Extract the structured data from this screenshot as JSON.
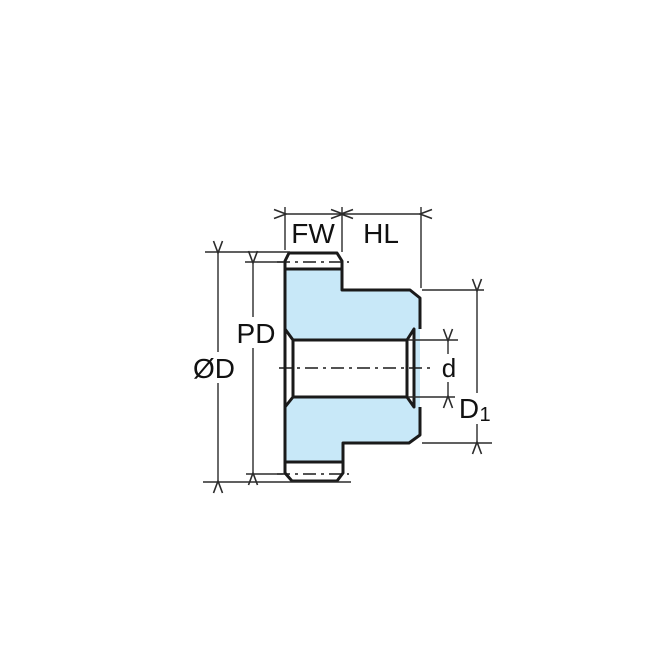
{
  "diagram": {
    "type": "technical-dimension-drawing",
    "subject": "spur-gear-side-profile"
  },
  "labels": {
    "face_width": "FW",
    "hub_length": "HL",
    "outside_diameter": "ØD",
    "pitch_diameter": "PD",
    "bore_diameter": "d",
    "hub_diameter_main": "D",
    "hub_diameter_sub": "1"
  },
  "colors": {
    "gear_fill": "#C8E8F8",
    "outline": "#1A1A1A",
    "dimension_line": "#2B2B2B",
    "background": "#FFFFFF"
  }
}
